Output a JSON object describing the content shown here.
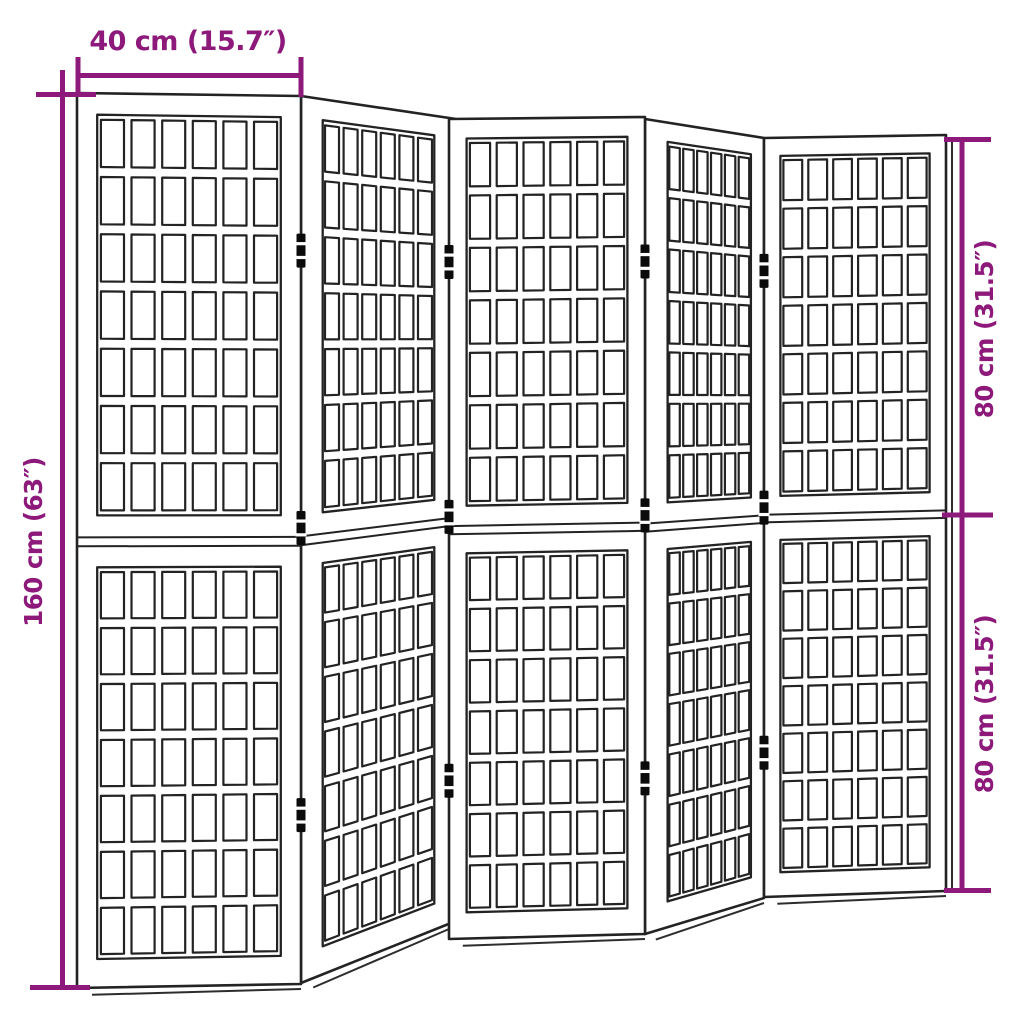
{
  "diagram": {
    "title": "folding-screen-dimension-diagram",
    "structure": {
      "panel_count": 5,
      "sections_per_panel": 2,
      "grid_columns": 6,
      "grid_rows_per_section": 7,
      "hinges_per_junction": 3
    }
  },
  "dimensions": {
    "width_top": "40 cm (15.7″)",
    "height_left": "160 cm (63″)",
    "height_right_upper": "80 cm (31.5″)",
    "height_right_lower": "80 cm (31.5″)"
  },
  "colors": {
    "dimension_accent": "#8d1a7b",
    "outline": "#222222",
    "background": "#ffffff"
  }
}
